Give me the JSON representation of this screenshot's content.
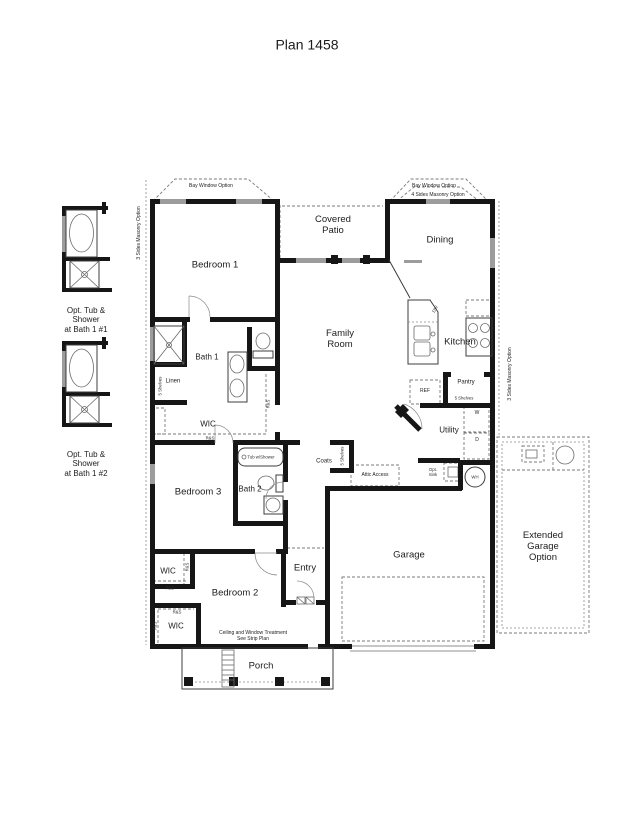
{
  "title": "Plan 1458",
  "colors": {
    "wall": "#161616",
    "window": "#9c9c9c",
    "dashed_line": "#7a7a7a",
    "text": "#1c1c1c",
    "background": "#ffffff"
  },
  "rooms": {
    "bedroom1": "Bedroom 1",
    "covered_patio": [
      "Covered",
      "Patio"
    ],
    "dining": "Dining",
    "family_room": [
      "Family",
      "Room"
    ],
    "kitchen": "Kitchen",
    "bath1": "Bath 1",
    "linen": "Linen",
    "wic": "WIC",
    "bedroom3": "Bedroom 3",
    "bath2": "Bath 2",
    "bedroom2": "Bedroom 2",
    "entry": "Entry",
    "garage": "Garage",
    "porch": "Porch",
    "utility": "Utility",
    "coats": "Coats",
    "pantry": "Pantry",
    "extended_garage": [
      "Extended",
      "Garage",
      "Option"
    ]
  },
  "options_left": {
    "option1": [
      "Opt. Tub &",
      "Shower",
      "at Bath 1 #1"
    ],
    "option2": [
      "Opt. Tub &",
      "Shower",
      "at Bath 1 #2"
    ]
  },
  "annotations": {
    "bay_window": "Bay Window Option",
    "masonry_4_sides": "4 Sides Masonry Option",
    "masonry_3_sides": "3 Sides Masonry Option",
    "attic_access": "Attic Access",
    "ceiling_note": [
      "Ceiling and Window Treatment",
      "See Strip Plan"
    ],
    "rod_and_shelf": "R&S"
  },
  "fixtures": {
    "dishwasher": "DW",
    "refrigerator": "REF",
    "washer": "W",
    "dryer": "D",
    "water_heater": "WH",
    "opt_sink": [
      "Opt.",
      "Sink"
    ],
    "tub_shower": "Tub w/Shower",
    "shelves": "5 Shelves"
  }
}
